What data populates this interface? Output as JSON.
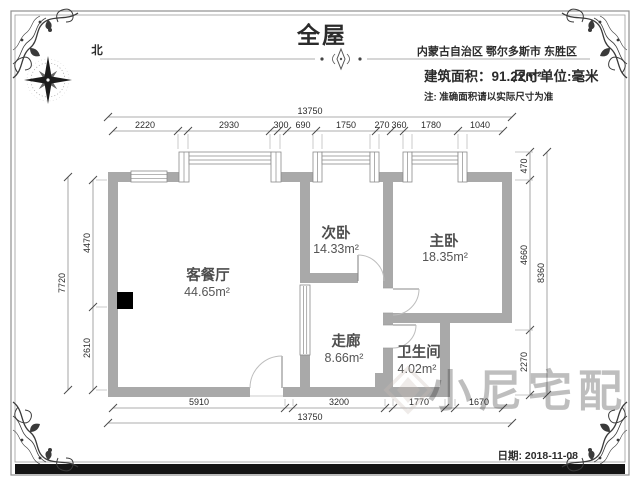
{
  "page": {
    "title": "全屋",
    "region": "内蒙古自治区 鄂尔多斯市 东胜区",
    "area_label": "建筑面积：91.22m²",
    "unit_label": "尺寸单位:毫米",
    "note": "注: 准确面积请以实际尺寸为准",
    "compass_label": "北",
    "date_label": "日期: 2018-11-08",
    "watermark_text": "小尼宅配"
  },
  "rooms": {
    "living": {
      "name": "客餐厅",
      "area": "44.65m²"
    },
    "second_bedroom": {
      "name": "次卧",
      "area": "14.33m²"
    },
    "master_bedroom": {
      "name": "主卧",
      "area": "18.35m²"
    },
    "corridor": {
      "name": "走廊",
      "area": "8.66m²"
    },
    "bathroom": {
      "name": "卫生间",
      "area": "4.02m²"
    }
  },
  "dimensions": {
    "top_total": "13750",
    "top_segments": [
      "2220",
      "2930",
      "300",
      "690",
      "1750",
      "270",
      "360",
      "1780",
      "1040"
    ],
    "bottom_segments": [
      "5910",
      "3200",
      "1770",
      "1670"
    ],
    "bottom_total": "13750",
    "left_segments": [
      "4470",
      "2610"
    ],
    "left_total": "7720",
    "right_segments": [
      "470",
      "4660",
      "2270"
    ],
    "right_total": "8360"
  },
  "colors": {
    "wall": "#a9a9a9",
    "frame": "#8f8f8f",
    "footer_bar": "#151515"
  }
}
